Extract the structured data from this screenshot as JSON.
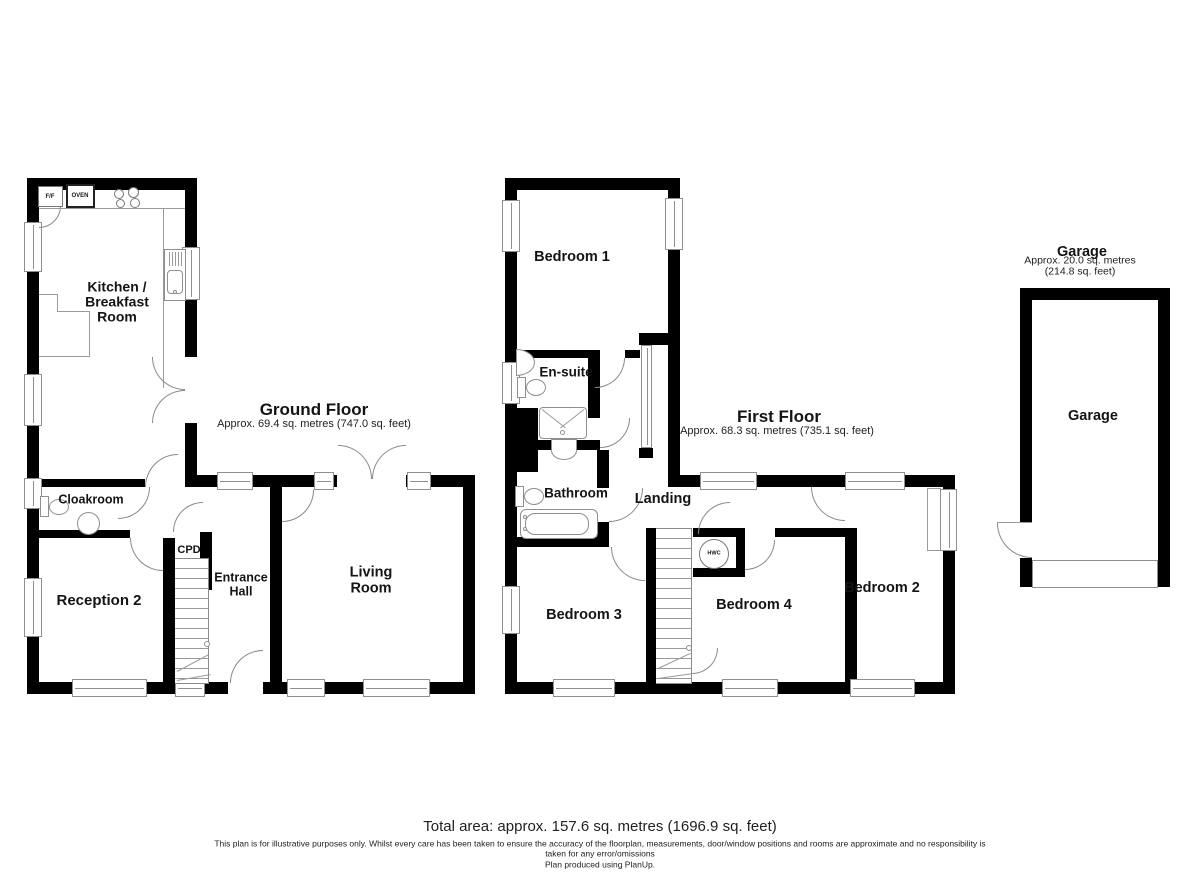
{
  "floors": {
    "ground": {
      "title": "Ground Floor",
      "area": "Approx. 69.4 sq. metres (747.0 sq. feet)",
      "rooms": {
        "kitchen": "Kitchen /\nBreakfast\nRoom",
        "cloakroom": "Cloakroom",
        "reception2": "Reception 2",
        "cpd": "CPD",
        "entrance_hall": "Entrance\nHall",
        "living": "Living\nRoom"
      },
      "appliances": {
        "ff": "F/F",
        "oven": "OVEN"
      }
    },
    "first": {
      "title": "First Floor",
      "area": "Approx. 68.3 sq. metres (735.1 sq. feet)",
      "rooms": {
        "bedroom1": "Bedroom 1",
        "ensuite": "En-suite",
        "bathroom": "Bathroom",
        "landing": "Landing",
        "bedroom3": "Bedroom 3",
        "bedroom4": "Bedroom 4",
        "bedroom2": "Bedroom 2",
        "hwc": "HWC"
      }
    },
    "garage": {
      "title": "Garage",
      "area": "Approx. 20.0 sq. metres (214.8 sq. feet)",
      "rooms": {
        "garage": "Garage"
      }
    }
  },
  "footer": {
    "total_area": "Total area: approx. 157.6 sq. metres (1696.9 sq. feet)",
    "disclaimer_line1": "This plan is for illustrative purposes only. Whilst every care has been taken to ensure the accuracy of the floorplan, measurements, door/window positions and rooms are approximate and no responsibility is",
    "disclaimer_line2": "taken for any error/omissions",
    "disclaimer_line3": "Plan produced using PlanUp."
  },
  "colors": {
    "wall": "#000000",
    "door_arc": "#8a8a8a",
    "window_border": "#8f8f8f",
    "text": "#141414"
  }
}
